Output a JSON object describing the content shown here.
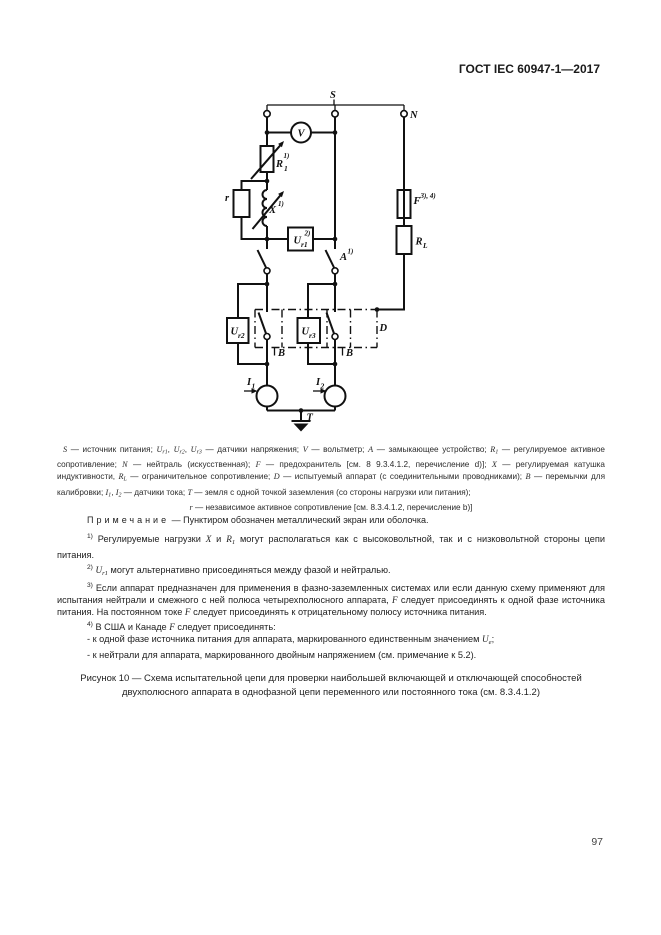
{
  "header": {
    "title": "ГОСТ IEC 60947-1—2017"
  },
  "page_number": "97",
  "diagram": {
    "labels": {
      "s": "S",
      "n": "N",
      "v": "V",
      "r1_base": "R",
      "r1_sub": "1",
      "r1_sup": "1)",
      "x_base": "X",
      "x_sup": "1)",
      "r_small": "r",
      "ur1_base": "U",
      "ur1_sub": "r1",
      "ur1_sup": "2)",
      "a_base": "A",
      "a_sup": "1)",
      "f_base": "F",
      "f_sup": "3), 4)",
      "rl_base": "R",
      "rl_sub": "L",
      "ur2_base": "U",
      "ur2_sub": "r2",
      "ur3_base": "U",
      "ur3_sub": "r3",
      "d": "D",
      "b_left": "B",
      "b_right": "B",
      "i1_base": "I",
      "i1_sub": "1",
      "i2_base": "I",
      "i2_sub": "2",
      "t": "T"
    }
  },
  "legend": {
    "segments": [
      {
        "t": "S",
        "s": "i"
      },
      {
        "t": " — источник питания; ",
        "s": "n"
      },
      {
        "t": "U",
        "s": "i"
      },
      {
        "t": "r1",
        "s": "sub"
      },
      {
        "t": ", ",
        "s": "n"
      },
      {
        "t": "U",
        "s": "i"
      },
      {
        "t": "r2",
        "s": "sub"
      },
      {
        "t": ", ",
        "s": "n"
      },
      {
        "t": "U",
        "s": "i"
      },
      {
        "t": "r3",
        "s": "sub"
      },
      {
        "t": " — датчики напряжения; ",
        "s": "n"
      },
      {
        "t": "V",
        "s": "i"
      },
      {
        "t": " — вольтметр; ",
        "s": "n"
      },
      {
        "t": "A",
        "s": "i"
      },
      {
        "t": " — замыкающее устройство; ",
        "s": "n"
      },
      {
        "t": "R",
        "s": "i"
      },
      {
        "t": "1",
        "s": "sub"
      },
      {
        "t": " — регулируемое активное сопротивление; ",
        "s": "n"
      },
      {
        "t": "N",
        "s": "i"
      },
      {
        "t": " — нейтраль (искусственная); ",
        "s": "n"
      },
      {
        "t": "F",
        "s": "i"
      },
      {
        "t": " — предохранитель [см. 8 9.3.4.1.2, перечисление d)]; ",
        "s": "n"
      },
      {
        "t": "X",
        "s": "i"
      },
      {
        "t": " — регулируемая катушка индуктивности, ",
        "s": "n"
      },
      {
        "t": "R",
        "s": "i"
      },
      {
        "t": "L",
        "s": "sub"
      },
      {
        "t": " — ограничительное сопротивление; ",
        "s": "n"
      },
      {
        "t": "D",
        "s": "i"
      },
      {
        "t": " — испытуемый аппарат (с соединительными проводниками); ",
        "s": "n"
      },
      {
        "t": "B",
        "s": "i"
      },
      {
        "t": " — перемычки для калибровки; ",
        "s": "n"
      },
      {
        "t": "I",
        "s": "i"
      },
      {
        "t": "1",
        "s": "sub"
      },
      {
        "t": ", ",
        "s": "n"
      },
      {
        "t": "I",
        "s": "i"
      },
      {
        "t": "2",
        "s": "sub"
      },
      {
        "t": " — датчики тока; ",
        "s": "n"
      },
      {
        "t": "T",
        "s": "i"
      },
      {
        "t": " — земля с одной точкой заземления (со стороны нагрузки или питания);",
        "s": "n"
      }
    ],
    "last_line": [
      {
        "t": "r",
        "s": "i"
      },
      {
        "t": " — независимое активное сопротивление [см. 8.3.4.1.2, перечисление b)]",
        "s": "n"
      }
    ]
  },
  "note": {
    "label": "Примечание",
    "rest": " — Пунктиром обозначен металлический экран или оболочка."
  },
  "footnotes": [
    {
      "marker": "1)",
      "segments": [
        {
          "t": " Регулируемые нагрузки ",
          "s": "n"
        },
        {
          "t": "X",
          "s": "i"
        },
        {
          "t": " и ",
          "s": "n"
        },
        {
          "t": "R",
          "s": "i"
        },
        {
          "t": "1",
          "s": "sub"
        },
        {
          "t": " могут располагаться как с высоковольтной, так и с низковольтной стороны цепи питания.",
          "s": "n"
        }
      ]
    },
    {
      "marker": "2)",
      "segments": [
        {
          "t": " ",
          "s": "n"
        },
        {
          "t": "U",
          "s": "i"
        },
        {
          "t": "r1",
          "s": "sub"
        },
        {
          "t": " могут альтернативно присоединяться между фазой и нейтралью.",
          "s": "n"
        }
      ]
    },
    {
      "marker": "3)",
      "segments": [
        {
          "t": " Если аппарат предназначен для применения в фазно-заземленных системах или если данную схему применяют для испытания нейтрали и смежного с ней полюса четырехполюсного аппарата, ",
          "s": "n"
        },
        {
          "t": "F",
          "s": "i"
        },
        {
          "t": " следует присоединять к одной фазе источника питания. На постоянном токе ",
          "s": "n"
        },
        {
          "t": "F",
          "s": "i"
        },
        {
          "t": " следует присоединять к отрицательному полюсу источника питания.",
          "s": "n"
        }
      ]
    },
    {
      "marker": "4)",
      "segments": [
        {
          "t": " В США и Канаде ",
          "s": "n"
        },
        {
          "t": "F",
          "s": "i"
        },
        {
          "t": " следует присоединять:",
          "s": "n"
        }
      ],
      "items": [
        [
          {
            "t": "- к одной фазе источника питания для аппарата, маркированного единственным значением ",
            "s": "n"
          },
          {
            "t": "U",
            "s": "i"
          },
          {
            "t": "e",
            "s": "sub"
          },
          {
            "t": ";",
            "s": "n"
          }
        ],
        [
          {
            "t": "- к нейтрали для аппарата, маркированного двойным напряжением (см. примечание к 5.2).",
            "s": "n"
          }
        ]
      ]
    }
  ],
  "caption": {
    "text": "Рисунок 10 — Схема испытательной цепи для проверки наибольшей включающей и отключающей способностей двухполюсного аппарата в однофазной цепи переменного или постоянного тока (см. 8.3.4.1.2)"
  }
}
